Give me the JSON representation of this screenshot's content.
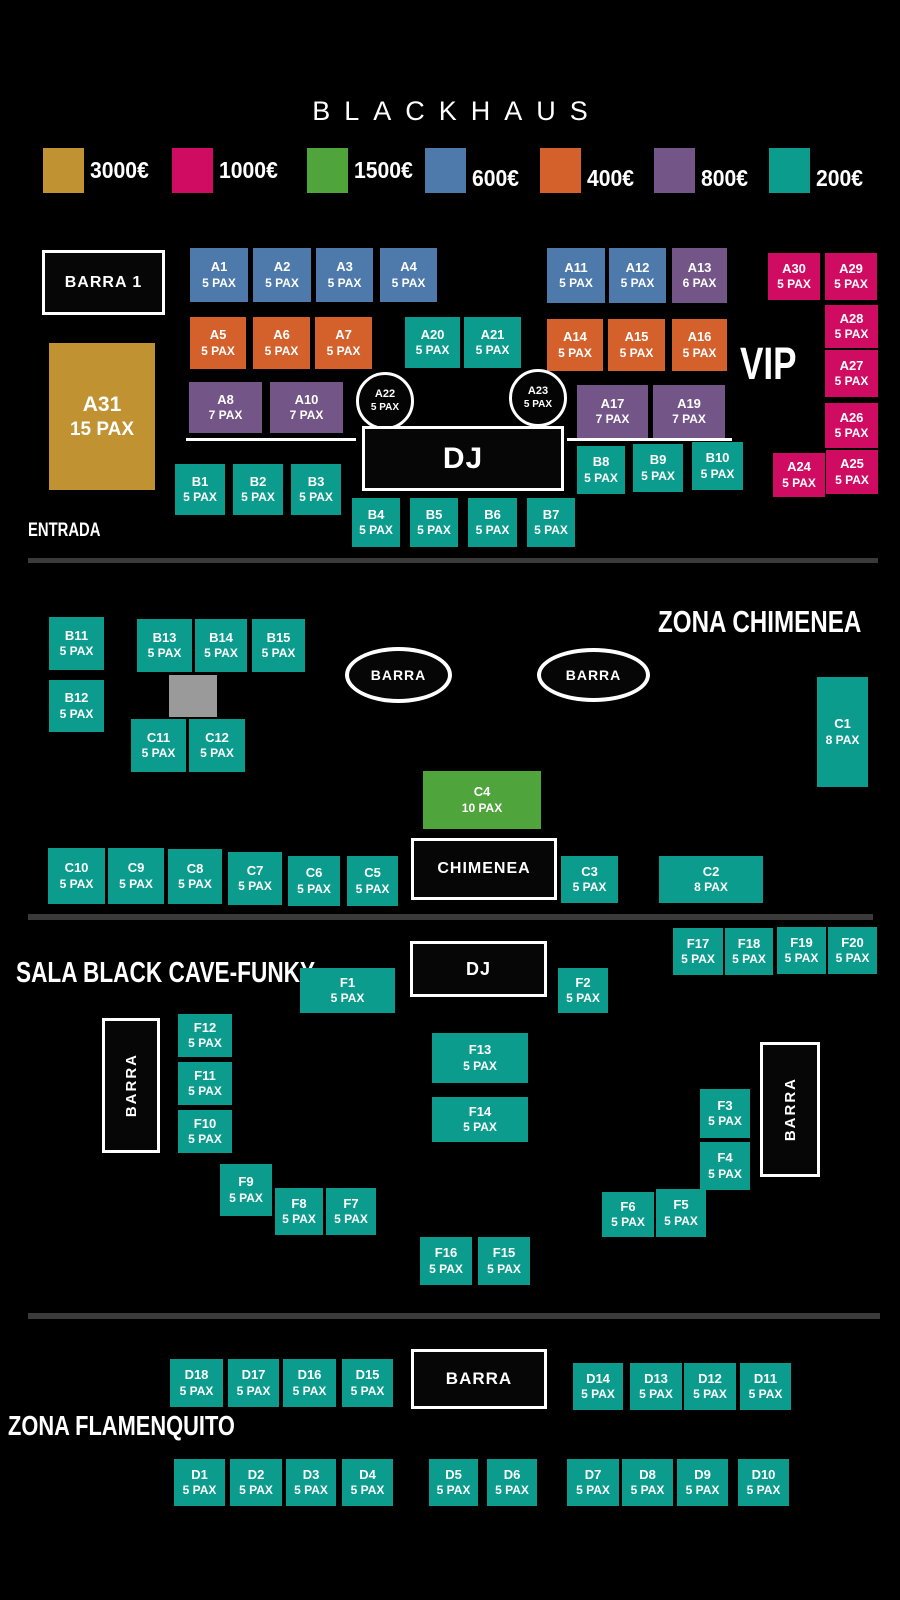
{
  "title": "BLACKHAUS",
  "colors": {
    "gold": "#c09232",
    "pink": "#d00b62",
    "green": "#4fa43c",
    "blue": "#4e79ab",
    "orange": "#d4612c",
    "purple": "#735587",
    "teal": "#0c9c8e",
    "divider": "#3a3a3a",
    "obstacle": "#9a9a9a",
    "booth": "#060606",
    "text": "#ffffff"
  },
  "legend": [
    {
      "label": "3000€",
      "color": "gold",
      "x": 43,
      "dy": 0
    },
    {
      "label": "1000€",
      "color": "pink",
      "x": 172,
      "dy": 0
    },
    {
      "label": "1500€",
      "color": "green",
      "x": 307,
      "dy": 0
    },
    {
      "label": "600€",
      "color": "blue",
      "x": 425,
      "dy": 8
    },
    {
      "label": "400€",
      "color": "orange",
      "x": 540,
      "dy": 8
    },
    {
      "label": "800€",
      "color": "purple",
      "x": 654,
      "dy": 8
    },
    {
      "label": "200€",
      "color": "teal",
      "x": 769,
      "dy": 8
    }
  ],
  "zone_titles": [
    {
      "id": "entrada",
      "text": "ENTRADA",
      "x": 28,
      "y": 521,
      "fs": 19
    },
    {
      "id": "zona-chimenea",
      "text": "ZONA CHIMENEA",
      "x": 658,
      "y": 606,
      "fs": 31
    },
    {
      "id": "sala-black-cave",
      "text": "SALA BLACK CAVE-FUNKY",
      "x": 16,
      "y": 958,
      "fs": 29
    },
    {
      "id": "zona-flamenquito",
      "text": "ZONA FLAMENQUITO",
      "x": 8,
      "y": 1411,
      "fs": 28
    },
    {
      "id": "vip",
      "text": "VIP",
      "x": 740,
      "y": 340,
      "fs": 45
    }
  ],
  "tables": [
    {
      "id": "A1",
      "pax": "5 PAX",
      "c": "blue",
      "x": 190,
      "y": 248,
      "w": 58,
      "h": 54
    },
    {
      "id": "A2",
      "pax": "5 PAX",
      "c": "blue",
      "x": 253,
      "y": 248,
      "w": 58,
      "h": 54
    },
    {
      "id": "A3",
      "pax": "5 PAX",
      "c": "blue",
      "x": 316,
      "y": 248,
      "w": 57,
      "h": 54
    },
    {
      "id": "A4",
      "pax": "5 PAX",
      "c": "blue",
      "x": 380,
      "y": 248,
      "w": 57,
      "h": 54
    },
    {
      "id": "A11",
      "pax": "5 PAX",
      "c": "blue",
      "x": 547,
      "y": 248,
      "w": 58,
      "h": 55
    },
    {
      "id": "A12",
      "pax": "5 PAX",
      "c": "blue",
      "x": 609,
      "y": 248,
      "w": 57,
      "h": 55
    },
    {
      "id": "A13",
      "pax": "6 PAX",
      "c": "purple",
      "x": 672,
      "y": 248,
      "w": 55,
      "h": 55
    },
    {
      "id": "A30",
      "pax": "5 PAX",
      "c": "pink",
      "x": 768,
      "y": 253,
      "w": 52,
      "h": 47
    },
    {
      "id": "A29",
      "pax": "5 PAX",
      "c": "pink",
      "x": 825,
      "y": 253,
      "w": 52,
      "h": 47
    },
    {
      "id": "A5",
      "pax": "5 PAX",
      "c": "orange",
      "x": 190,
      "y": 317,
      "w": 56,
      "h": 52
    },
    {
      "id": "A6",
      "pax": "5 PAX",
      "c": "orange",
      "x": 253,
      "y": 317,
      "w": 57,
      "h": 52
    },
    {
      "id": "A7",
      "pax": "5 PAX",
      "c": "orange",
      "x": 315,
      "y": 317,
      "w": 57,
      "h": 52
    },
    {
      "id": "A20",
      "pax": "5 PAX",
      "c": "teal",
      "x": 405,
      "y": 317,
      "w": 55,
      "h": 51
    },
    {
      "id": "A21",
      "pax": "5 PAX",
      "c": "teal",
      "x": 464,
      "y": 317,
      "w": 57,
      "h": 51
    },
    {
      "id": "A14",
      "pax": "5 PAX",
      "c": "orange",
      "x": 547,
      "y": 319,
      "w": 56,
      "h": 52
    },
    {
      "id": "A15",
      "pax": "5 PAX",
      "c": "orange",
      "x": 608,
      "y": 319,
      "w": 57,
      "h": 52
    },
    {
      "id": "A16",
      "pax": "5 PAX",
      "c": "orange",
      "x": 672,
      "y": 319,
      "w": 55,
      "h": 52
    },
    {
      "id": "A28",
      "pax": "5 PAX",
      "c": "pink",
      "x": 825,
      "y": 305,
      "w": 53,
      "h": 43
    },
    {
      "id": "A27",
      "pax": "5 PAX",
      "c": "pink",
      "x": 825,
      "y": 350,
      "w": 53,
      "h": 47
    },
    {
      "id": "A31",
      "pax": "15 PAX",
      "c": "gold",
      "x": 49,
      "y": 343,
      "w": 106,
      "h": 147,
      "big": true
    },
    {
      "id": "A8",
      "pax": "7 PAX",
      "c": "purple",
      "x": 189,
      "y": 382,
      "w": 73,
      "h": 51
    },
    {
      "id": "A10",
      "pax": "7 PAX",
      "c": "purple",
      "x": 270,
      "y": 382,
      "w": 73,
      "h": 51
    },
    {
      "id": "A22",
      "pax": "5 PAX",
      "c": "booth",
      "x": 356,
      "y": 372,
      "w": 58,
      "h": 58,
      "shape": "circle"
    },
    {
      "id": "A23",
      "pax": "5 PAX",
      "c": "booth",
      "x": 509,
      "y": 369,
      "w": 58,
      "h": 58,
      "shape": "circle"
    },
    {
      "id": "A17",
      "pax": "7 PAX",
      "c": "purple",
      "x": 577,
      "y": 385,
      "w": 71,
      "h": 53
    },
    {
      "id": "A19",
      "pax": "7 PAX",
      "c": "purple",
      "x": 653,
      "y": 385,
      "w": 72,
      "h": 53
    },
    {
      "id": "A26",
      "pax": "5 PAX",
      "c": "pink",
      "x": 825,
      "y": 403,
      "w": 53,
      "h": 45
    },
    {
      "id": "A24",
      "pax": "5 PAX",
      "c": "pink",
      "x": 773,
      "y": 453,
      "w": 52,
      "h": 44
    },
    {
      "id": "A25",
      "pax": "5 PAX",
      "c": "pink",
      "x": 826,
      "y": 450,
      "w": 52,
      "h": 44
    },
    {
      "id": "B1",
      "pax": "5 PAX",
      "c": "teal",
      "x": 175,
      "y": 464,
      "w": 50,
      "h": 51
    },
    {
      "id": "B2",
      "pax": "5 PAX",
      "c": "teal",
      "x": 233,
      "y": 464,
      "w": 50,
      "h": 51
    },
    {
      "id": "B3",
      "pax": "5 PAX",
      "c": "teal",
      "x": 291,
      "y": 464,
      "w": 50,
      "h": 51
    },
    {
      "id": "B8",
      "pax": "5 PAX",
      "c": "teal",
      "x": 577,
      "y": 446,
      "w": 48,
      "h": 48
    },
    {
      "id": "B9",
      "pax": "5 PAX",
      "c": "teal",
      "x": 633,
      "y": 444,
      "w": 50,
      "h": 48
    },
    {
      "id": "B10",
      "pax": "5 PAX",
      "c": "teal",
      "x": 692,
      "y": 442,
      "w": 51,
      "h": 48
    },
    {
      "id": "B4",
      "pax": "5 PAX",
      "c": "teal",
      "x": 352,
      "y": 498,
      "w": 48,
      "h": 49
    },
    {
      "id": "B5",
      "pax": "5 PAX",
      "c": "teal",
      "x": 410,
      "y": 498,
      "w": 48,
      "h": 49
    },
    {
      "id": "B6",
      "pax": "5 PAX",
      "c": "teal",
      "x": 468,
      "y": 498,
      "w": 49,
      "h": 49
    },
    {
      "id": "B7",
      "pax": "5 PAX",
      "c": "teal",
      "x": 527,
      "y": 498,
      "w": 48,
      "h": 49
    },
    {
      "id": "B11",
      "pax": "5 PAX",
      "c": "teal",
      "x": 49,
      "y": 617,
      "w": 55,
      "h": 53
    },
    {
      "id": "B13",
      "pax": "5 PAX",
      "c": "teal",
      "x": 137,
      "y": 619,
      "w": 55,
      "h": 53
    },
    {
      "id": "B14",
      "pax": "5 PAX",
      "c": "teal",
      "x": 195,
      "y": 619,
      "w": 52,
      "h": 53
    },
    {
      "id": "B15",
      "pax": "5 PAX",
      "c": "teal",
      "x": 252,
      "y": 619,
      "w": 53,
      "h": 53
    },
    {
      "id": "B12",
      "pax": "5 PAX",
      "c": "teal",
      "x": 49,
      "y": 680,
      "w": 55,
      "h": 52
    },
    {
      "id": "C11",
      "pax": "5 PAX",
      "c": "teal",
      "x": 131,
      "y": 719,
      "w": 55,
      "h": 53
    },
    {
      "id": "C12",
      "pax": "5 PAX",
      "c": "teal",
      "x": 189,
      "y": 719,
      "w": 56,
      "h": 53
    },
    {
      "id": "C1",
      "pax": "8 PAX",
      "c": "teal",
      "x": 817,
      "y": 677,
      "w": 51,
      "h": 110
    },
    {
      "id": "C4",
      "pax": "10 PAX",
      "c": "green",
      "x": 423,
      "y": 771,
      "w": 118,
      "h": 58
    },
    {
      "id": "C10",
      "pax": "5 PAX",
      "c": "teal",
      "x": 48,
      "y": 848,
      "w": 57,
      "h": 56
    },
    {
      "id": "C9",
      "pax": "5 PAX",
      "c": "teal",
      "x": 108,
      "y": 848,
      "w": 56,
      "h": 56
    },
    {
      "id": "C8",
      "pax": "5 PAX",
      "c": "teal",
      "x": 168,
      "y": 849,
      "w": 54,
      "h": 55
    },
    {
      "id": "C7",
      "pax": "5 PAX",
      "c": "teal",
      "x": 228,
      "y": 852,
      "w": 54,
      "h": 53
    },
    {
      "id": "C6",
      "pax": "5 PAX",
      "c": "teal",
      "x": 288,
      "y": 856,
      "w": 52,
      "h": 50
    },
    {
      "id": "C5",
      "pax": "5 PAX",
      "c": "teal",
      "x": 347,
      "y": 856,
      "w": 51,
      "h": 50
    },
    {
      "id": "C3",
      "pax": "5 PAX",
      "c": "teal",
      "x": 561,
      "y": 856,
      "w": 57,
      "h": 47
    },
    {
      "id": "C2",
      "pax": "8 PAX",
      "c": "teal",
      "x": 659,
      "y": 856,
      "w": 104,
      "h": 47
    },
    {
      "id": "F17",
      "pax": "5 PAX",
      "c": "teal",
      "x": 673,
      "y": 928,
      "w": 50,
      "h": 47
    },
    {
      "id": "F18",
      "pax": "5 PAX",
      "c": "teal",
      "x": 725,
      "y": 928,
      "w": 48,
      "h": 47
    },
    {
      "id": "F19",
      "pax": "5 PAX",
      "c": "teal",
      "x": 777,
      "y": 927,
      "w": 49,
      "h": 47
    },
    {
      "id": "F20",
      "pax": "5 PAX",
      "c": "teal",
      "x": 828,
      "y": 927,
      "w": 49,
      "h": 47
    },
    {
      "id": "F1",
      "pax": "5 PAX",
      "c": "teal",
      "x": 300,
      "y": 968,
      "w": 95,
      "h": 45
    },
    {
      "id": "F2",
      "pax": "5 PAX",
      "c": "teal",
      "x": 558,
      "y": 968,
      "w": 50,
      "h": 45
    },
    {
      "id": "F12",
      "pax": "5 PAX",
      "c": "teal",
      "x": 178,
      "y": 1014,
      "w": 54,
      "h": 43
    },
    {
      "id": "F11",
      "pax": "5 PAX",
      "c": "teal",
      "x": 178,
      "y": 1062,
      "w": 54,
      "h": 43
    },
    {
      "id": "F10",
      "pax": "5 PAX",
      "c": "teal",
      "x": 178,
      "y": 1110,
      "w": 54,
      "h": 43
    },
    {
      "id": "F13",
      "pax": "5 PAX",
      "c": "teal",
      "x": 432,
      "y": 1033,
      "w": 96,
      "h": 50
    },
    {
      "id": "F14",
      "pax": "5 PAX",
      "c": "teal",
      "x": 432,
      "y": 1097,
      "w": 96,
      "h": 45
    },
    {
      "id": "F3",
      "pax": "5 PAX",
      "c": "teal",
      "x": 700,
      "y": 1089,
      "w": 50,
      "h": 49
    },
    {
      "id": "F4",
      "pax": "5 PAX",
      "c": "teal",
      "x": 700,
      "y": 1142,
      "w": 50,
      "h": 48
    },
    {
      "id": "F9",
      "pax": "5 PAX",
      "c": "teal",
      "x": 220,
      "y": 1164,
      "w": 52,
      "h": 52
    },
    {
      "id": "F8",
      "pax": "5 PAX",
      "c": "teal",
      "x": 275,
      "y": 1188,
      "w": 48,
      "h": 47
    },
    {
      "id": "F7",
      "pax": "5 PAX",
      "c": "teal",
      "x": 326,
      "y": 1188,
      "w": 50,
      "h": 47
    },
    {
      "id": "F6",
      "pax": "5 PAX",
      "c": "teal",
      "x": 602,
      "y": 1192,
      "w": 52,
      "h": 45
    },
    {
      "id": "F5",
      "pax": "5 PAX",
      "c": "teal",
      "x": 656,
      "y": 1189,
      "w": 50,
      "h": 48
    },
    {
      "id": "F16",
      "pax": "5 PAX",
      "c": "teal",
      "x": 420,
      "y": 1237,
      "w": 52,
      "h": 48
    },
    {
      "id": "F15",
      "pax": "5 PAX",
      "c": "teal",
      "x": 478,
      "y": 1237,
      "w": 52,
      "h": 48
    },
    {
      "id": "D18",
      "pax": "5 PAX",
      "c": "teal",
      "x": 170,
      "y": 1359,
      "w": 53,
      "h": 48
    },
    {
      "id": "D17",
      "pax": "5 PAX",
      "c": "teal",
      "x": 228,
      "y": 1359,
      "w": 51,
      "h": 48
    },
    {
      "id": "D16",
      "pax": "5 PAX",
      "c": "teal",
      "x": 283,
      "y": 1359,
      "w": 53,
      "h": 48
    },
    {
      "id": "D15",
      "pax": "5 PAX",
      "c": "teal",
      "x": 342,
      "y": 1359,
      "w": 51,
      "h": 48
    },
    {
      "id": "D14",
      "pax": "5 PAX",
      "c": "teal",
      "x": 573,
      "y": 1363,
      "w": 50,
      "h": 47
    },
    {
      "id": "D13",
      "pax": "5 PAX",
      "c": "teal",
      "x": 630,
      "y": 1363,
      "w": 52,
      "h": 47
    },
    {
      "id": "D12",
      "pax": "5 PAX",
      "c": "teal",
      "x": 684,
      "y": 1363,
      "w": 52,
      "h": 47
    },
    {
      "id": "D11",
      "pax": "5 PAX",
      "c": "teal",
      "x": 740,
      "y": 1363,
      "w": 51,
      "h": 47
    },
    {
      "id": "D1",
      "pax": "5 PAX",
      "c": "teal",
      "x": 174,
      "y": 1459,
      "w": 51,
      "h": 47
    },
    {
      "id": "D2",
      "pax": "5 PAX",
      "c": "teal",
      "x": 230,
      "y": 1459,
      "w": 52,
      "h": 47
    },
    {
      "id": "D3",
      "pax": "5 PAX",
      "c": "teal",
      "x": 286,
      "y": 1459,
      "w": 50,
      "h": 47
    },
    {
      "id": "D4",
      "pax": "5 PAX",
      "c": "teal",
      "x": 342,
      "y": 1459,
      "w": 51,
      "h": 47
    },
    {
      "id": "D5",
      "pax": "5 PAX",
      "c": "teal",
      "x": 429,
      "y": 1459,
      "w": 49,
      "h": 47
    },
    {
      "id": "D6",
      "pax": "5 PAX",
      "c": "teal",
      "x": 487,
      "y": 1459,
      "w": 50,
      "h": 47
    },
    {
      "id": "D7",
      "pax": "5 PAX",
      "c": "teal",
      "x": 567,
      "y": 1459,
      "w": 52,
      "h": 47
    },
    {
      "id": "D8",
      "pax": "5 PAX",
      "c": "teal",
      "x": 622,
      "y": 1459,
      "w": 51,
      "h": 47
    },
    {
      "id": "D9",
      "pax": "5 PAX",
      "c": "teal",
      "x": 677,
      "y": 1459,
      "w": 51,
      "h": 47
    },
    {
      "id": "D10",
      "pax": "5 PAX",
      "c": "teal",
      "x": 738,
      "y": 1459,
      "w": 51,
      "h": 47
    }
  ],
  "fixtures": [
    {
      "label": "BARRA 1",
      "name": "barra-1-bar",
      "kind": "box",
      "x": 42,
      "y": 250,
      "w": 123,
      "h": 65,
      "fs": 16
    },
    {
      "label": "DJ",
      "name": "dj-booth-main",
      "kind": "box",
      "x": 362,
      "y": 426,
      "w": 202,
      "h": 65,
      "fs": 30
    },
    {
      "label": "BARRA",
      "name": "barra-ellipse-left",
      "kind": "ellipse",
      "x": 345,
      "y": 647,
      "w": 107,
      "h": 56,
      "fs": 14
    },
    {
      "label": "BARRA",
      "name": "barra-ellipse-right",
      "kind": "ellipse",
      "x": 537,
      "y": 648,
      "w": 113,
      "h": 54,
      "fs": 14
    },
    {
      "label": "CHIMENEA",
      "name": "chimenea-fireplace",
      "kind": "box",
      "x": 411,
      "y": 838,
      "w": 146,
      "h": 62,
      "fs": 16
    },
    {
      "label": "DJ",
      "name": "dj-booth-funky",
      "kind": "box",
      "x": 410,
      "y": 941,
      "w": 137,
      "h": 56,
      "fs": 18
    },
    {
      "label": "BARRA",
      "name": "barra-vertical-left",
      "kind": "vbox",
      "x": 102,
      "y": 1018,
      "w": 58,
      "h": 135,
      "fs": 15
    },
    {
      "label": "BARRA",
      "name": "barra-vertical-right",
      "kind": "vbox",
      "x": 760,
      "y": 1042,
      "w": 60,
      "h": 135,
      "fs": 15
    },
    {
      "label": "BARRA",
      "name": "barra-flamenquito",
      "kind": "box",
      "x": 411,
      "y": 1349,
      "w": 136,
      "h": 60,
      "fs": 17
    }
  ],
  "decor": [
    {
      "name": "stage-line-left",
      "kind": "wline",
      "x": 186,
      "y": 438,
      "w": 170,
      "h": 3
    },
    {
      "name": "stage-line-right",
      "kind": "wline",
      "x": 567,
      "y": 438,
      "w": 165,
      "h": 3
    },
    {
      "name": "zone-divider-1",
      "kind": "divider",
      "x": 28,
      "y": 558,
      "w": 850,
      "h": 5
    },
    {
      "name": "zone-divider-2",
      "kind": "divider",
      "x": 28,
      "y": 914,
      "w": 845,
      "h": 6
    },
    {
      "name": "zone-divider-3",
      "kind": "divider",
      "x": 28,
      "y": 1313,
      "w": 852,
      "h": 6
    },
    {
      "name": "column-obstacle",
      "kind": "obstacle",
      "x": 169,
      "y": 675,
      "w": 48,
      "h": 42
    }
  ]
}
